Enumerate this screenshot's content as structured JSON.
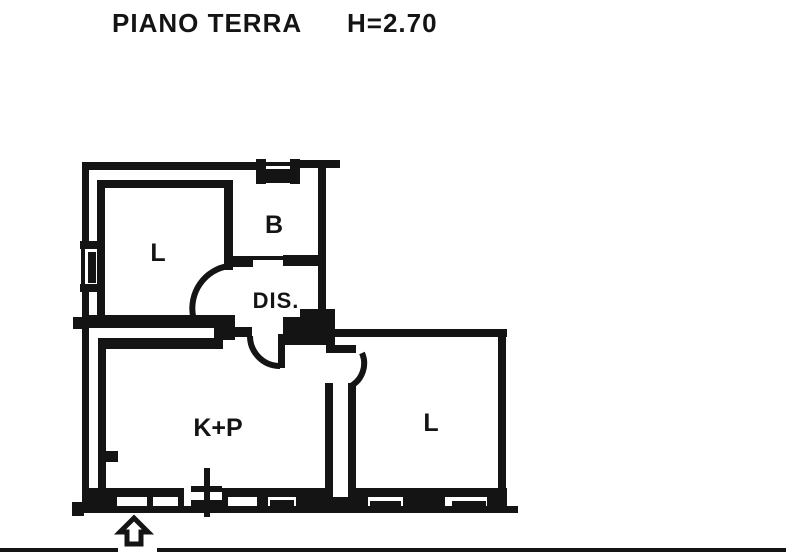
{
  "header": {
    "title": "PIANO TERRA",
    "height_label": "H=2.70"
  },
  "floor_plan": {
    "rooms": [
      {
        "name": "living-room-upper",
        "label": "L"
      },
      {
        "name": "bathroom",
        "label": "B"
      },
      {
        "name": "hallway",
        "label": "DIS."
      },
      {
        "name": "kitchen-dining",
        "label": "K+P"
      },
      {
        "name": "living-room-right",
        "label": "L"
      }
    ],
    "icons": {
      "entrance_arrow": "hollow-up-arrow"
    },
    "colors": {
      "ink": "#141414",
      "paper": "#ffffff"
    }
  }
}
